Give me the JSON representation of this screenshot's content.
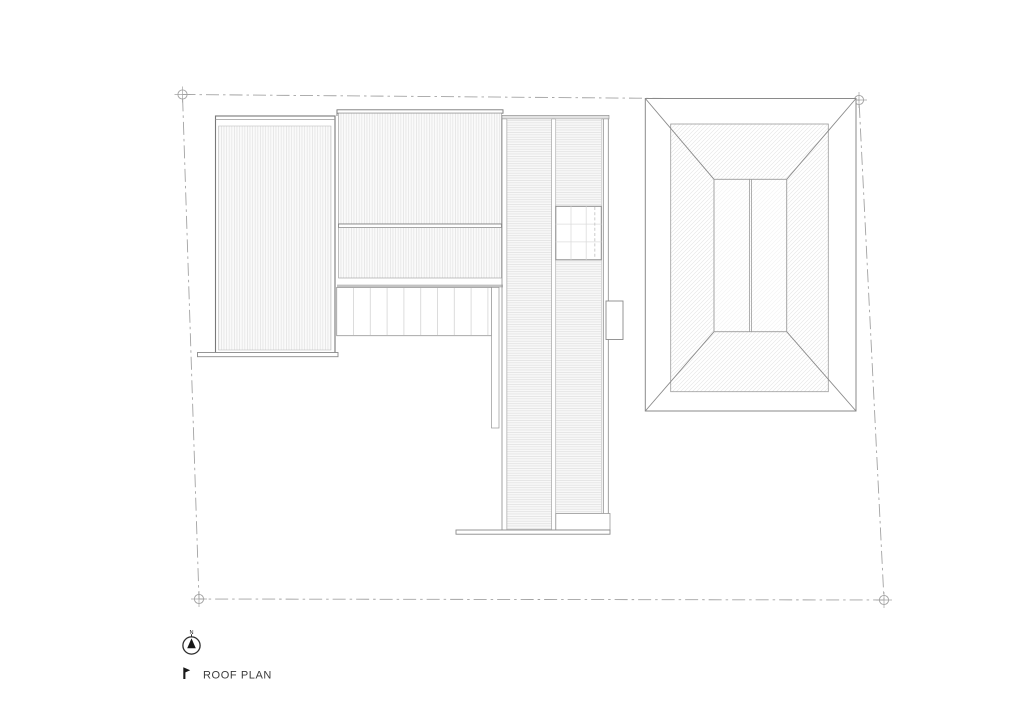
{
  "drawing": {
    "title_label": "ROOF PLAN",
    "title_marker": "flag-icon",
    "north_label": "N"
  },
  "plan": {
    "boundary": {
      "style": "dash-dot property line",
      "corner_markers": [
        "boundary-marker-top-left",
        "boundary-marker-top-right",
        "boundary-marker-bottom-right",
        "boundary-marker-bottom-left"
      ]
    },
    "roof_elements": [
      "left-wing-roof-vertical-seam-hatch",
      "central-wing-roof-vertical-seam-hatch",
      "pergola-slatted-canopy",
      "spine-roof-horizontal-seam-hatch",
      "spine-skylight-grid",
      "spine-side-box",
      "terrace-plinth-edge",
      "hip-roof-outbuilding-diagonal-hatch"
    ]
  },
  "colors": {
    "background": "#ffffff",
    "boundary_line": "#a3a3a3",
    "outline": "#8a8a8a",
    "outline_dark": "#787878",
    "hatch_fine": "#dcdcdc",
    "gray_band": "#c2c2c2",
    "title_text": "#3a3a3a",
    "north_symbol": "#1a1a1a"
  }
}
